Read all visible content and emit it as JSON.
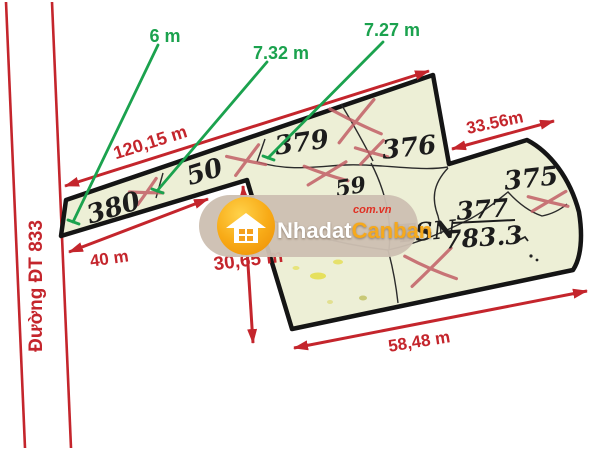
{
  "diagram": {
    "road": {
      "label": "Đường ĐT 833"
    },
    "plots": {
      "p380": "380",
      "p50": "50",
      "p379": "379",
      "p376": "376",
      "p59": "59",
      "p375": "375",
      "tsn": {
        "code": "TSN",
        "numerator": "377",
        "denominator": "783.3"
      }
    },
    "green_measures": {
      "m1": "6 m",
      "m2": "7.32 m",
      "m3": "7.27 m"
    },
    "red_dimensions": {
      "top": "120,15 m",
      "front": "40 m",
      "left": "30,65 m",
      "bottom": "58,48 m",
      "right": "33.56m"
    }
  },
  "watermark": {
    "brand_white": "Nhadat",
    "brand_orange": "Canban",
    "suffix": "com.vn"
  },
  "colors": {
    "dimension_red": "#c4252c",
    "measure_green": "#1ba24e",
    "parcel_fill": "#edefd6",
    "parcel_outline": "#151515",
    "x_mark": "#c25f66",
    "watermark_bg": "#cdbfb2",
    "watermark_orange": "#f5a01e"
  }
}
